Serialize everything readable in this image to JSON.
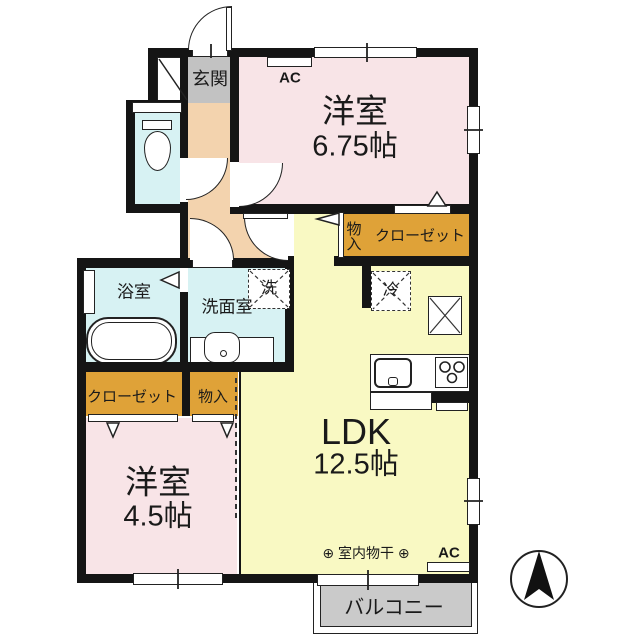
{
  "plan": {
    "type": "Japanese apartment floor plan (1LDK+2 rooms)",
    "rooms": {
      "entrance": {
        "name": "玄関"
      },
      "western_room_1": {
        "name": "洋室",
        "area": "6.75帖"
      },
      "western_room_2": {
        "name": "洋室",
        "area": "4.5帖"
      },
      "ldk": {
        "name": "LDK",
        "area": "12.5帖"
      },
      "bathroom": {
        "name": "浴室"
      },
      "washroom": {
        "name": "洗面室"
      },
      "balcony": {
        "name": "バルコニー"
      }
    },
    "storage": {
      "closet_upper": {
        "name": "クローゼット"
      },
      "storage_upper": {
        "name": "物入"
      },
      "closet_lower": {
        "name": "クローゼット"
      },
      "storage_lower": {
        "name": "物入"
      }
    },
    "equipment": {
      "washer_space": {
        "name": "洗"
      },
      "refrigerator_space": {
        "name": "冷"
      },
      "indoor_drying": {
        "name": "⊕ 室内物干 ⊕"
      },
      "ac_upper": {
        "name": "AC"
      },
      "ac_lower": {
        "name": "AC"
      }
    },
    "icons": {
      "compass": "north-arrow"
    },
    "colors": {
      "wall": "#151515",
      "western_room": "#f8e4e7",
      "ldk": "#f9f9c3",
      "wet_area": "#d7f2f3",
      "hallway": "#f3d3ae",
      "entrance": "#c2c2c2",
      "closet": "#dfa238",
      "balcony": "#cacaca"
    }
  }
}
